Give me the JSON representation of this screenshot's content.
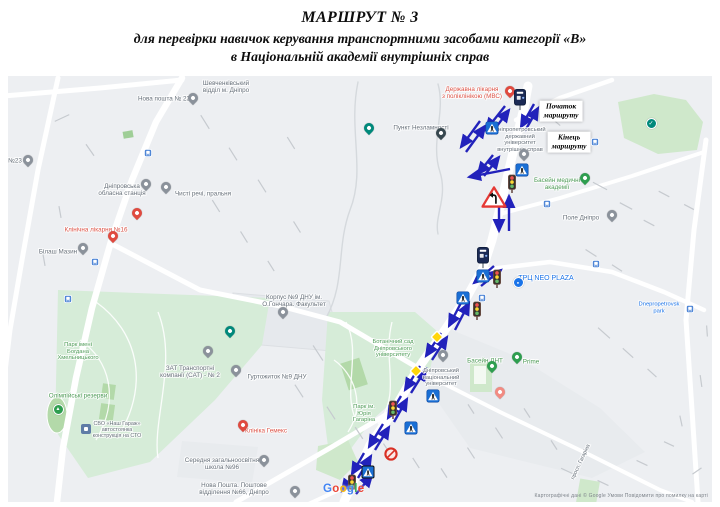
{
  "title": {
    "line1": "МАРШРУТ № 3",
    "line2": "для перевірки навичок керування транспортними засобами категорії «В»",
    "line3": "в Національній академії внутрішніх справ"
  },
  "colors": {
    "arrow": "#2222bb",
    "gray": "#67707a",
    "red": "#dd5347",
    "green": "#4e9b57",
    "blue": "#1a73e8",
    "pin_red": "#e04a3f",
    "pin_salmon": "#f28b82",
    "pin_gray": "#8b929b",
    "pin_navy": "#37474f",
    "pin_teal": "#00897b",
    "pin_green": "#2e9e4f",
    "pin_blue": "#1a73e8",
    "pin_slate": "#5f7ca6"
  },
  "map": {
    "route_labels": [
      {
        "text": "Початок\nмаршруту",
        "x": 561,
        "y": 111
      },
      {
        "text": "Кінець\nмаршруту",
        "x": 569,
        "y": 142
      }
    ],
    "labels": [
      {
        "text": "Нова пошта № 23",
        "x": 164,
        "y": 99,
        "color": "gray"
      },
      {
        "text": "Шевченківський\nвідділ м. Дніпро",
        "x": 226,
        "y": 87,
        "color": "gray"
      },
      {
        "text": "№23",
        "x": 15,
        "y": 161,
        "color": "gray"
      },
      {
        "text": "Дніпровська\nобласна станція",
        "x": 122,
        "y": 190,
        "color": "gray"
      },
      {
        "text": "Чисті речі, пральня",
        "x": 203,
        "y": 194,
        "color": "gray"
      },
      {
        "text": "Клінічна лікарня №16",
        "x": 96,
        "y": 230,
        "color": "red"
      },
      {
        "text": "Білаш Мазин",
        "x": 58,
        "y": 252,
        "color": "gray"
      },
      {
        "text": "Пункт Незламності",
        "x": 421,
        "y": 128,
        "color": "gray"
      },
      {
        "text": "Державна лікарня\nз поліклінікою (МВС)",
        "x": 472,
        "y": 93,
        "color": "red"
      },
      {
        "text": "Дніпропетровський\nдержавний\nуніверситет\nвнутрішніх справ",
        "x": 520,
        "y": 140,
        "color": "gray",
        "size": 5.8
      },
      {
        "text": "Басейн медичні\nакадемії",
        "x": 557,
        "y": 184,
        "color": "green"
      },
      {
        "text": "Поле Дніпро",
        "x": 581,
        "y": 218,
        "color": "gray"
      },
      {
        "text": "ТРЦ NEO PLAZA",
        "x": 546,
        "y": 279,
        "color": "blue",
        "size": 7
      },
      {
        "text": "Dnepropetrovsk park",
        "x": 659,
        "y": 308,
        "color": "blue",
        "size": 5.8
      },
      {
        "text": "Корпус №9 ДНУ ім.\nО.Гончара. Факультет",
        "x": 294,
        "y": 301,
        "color": "gray"
      },
      {
        "text": "Гуртожиток №9 ДНУ",
        "x": 277,
        "y": 377,
        "color": "gray"
      },
      {
        "text": "Ботанічний сад\nДніпровського\nуніверситету",
        "x": 393,
        "y": 349,
        "color": "green",
        "size": 5.8
      },
      {
        "text": "Дніпровський\nнаціональний\nуніверситет",
        "x": 441,
        "y": 378,
        "color": "gray",
        "size": 5.8
      },
      {
        "text": "Басейн ДНТ",
        "x": 485,
        "y": 361,
        "color": "green"
      },
      {
        "text": "Prime",
        "x": 531,
        "y": 362,
        "color": "green"
      },
      {
        "text": "ЗАТ Транспортні\nкомпанії (САТ) - № 2",
        "x": 190,
        "y": 372,
        "color": "gray"
      },
      {
        "text": "Парк імені\nБогдана\nХмельницького",
        "x": 78,
        "y": 352,
        "color": "green",
        "size": 5.8
      },
      {
        "text": "Олімпійські резерви",
        "x": 78,
        "y": 396,
        "color": "green"
      },
      {
        "text": "СВО «Наш Гараж»\nавтостоянка\nконструкція на СТО",
        "x": 117,
        "y": 430,
        "color": "gray",
        "size": 5.4
      },
      {
        "text": "Парк ім.\nЮрія\nГагаріна",
        "x": 364,
        "y": 414,
        "color": "green",
        "size": 5.8
      },
      {
        "text": "Клініка Гемекс",
        "x": 266,
        "y": 431,
        "color": "red"
      },
      {
        "text": "Середня загальноосвітня\nшкола №96",
        "x": 222,
        "y": 464,
        "color": "gray"
      },
      {
        "text": "Нова Пошта. Поштове\nвідділення №66, Дніпро",
        "x": 234,
        "y": 489,
        "color": "gray"
      },
      {
        "text": "просп. Гагаріна",
        "x": 581,
        "y": 462,
        "color": "gray",
        "size": 5.4,
        "rot": -65
      }
    ],
    "pins": [
      {
        "x": 510,
        "y": 97,
        "kind": "red"
      },
      {
        "x": 137,
        "y": 219,
        "kind": "red"
      },
      {
        "x": 113,
        "y": 242,
        "kind": "red"
      },
      {
        "x": 243,
        "y": 431,
        "kind": "red"
      },
      {
        "x": 500,
        "y": 398,
        "kind": "salmon"
      },
      {
        "x": 193,
        "y": 104,
        "kind": "gray"
      },
      {
        "x": 28,
        "y": 166,
        "kind": "gray"
      },
      {
        "x": 146,
        "y": 190,
        "kind": "gray"
      },
      {
        "x": 166,
        "y": 193,
        "kind": "gray"
      },
      {
        "x": 83,
        "y": 254,
        "kind": "gray"
      },
      {
        "x": 283,
        "y": 318,
        "kind": "gray"
      },
      {
        "x": 236,
        "y": 376,
        "kind": "gray"
      },
      {
        "x": 208,
        "y": 357,
        "kind": "gray"
      },
      {
        "x": 443,
        "y": 361,
        "kind": "gray"
      },
      {
        "x": 524,
        "y": 160,
        "kind": "gray"
      },
      {
        "x": 264,
        "y": 466,
        "kind": "gray"
      },
      {
        "x": 295,
        "y": 497,
        "kind": "gray"
      },
      {
        "x": 612,
        "y": 221,
        "kind": "gray"
      },
      {
        "x": 441,
        "y": 139,
        "kind": "navy"
      },
      {
        "x": 369,
        "y": 134,
        "kind": "teal"
      },
      {
        "x": 230,
        "y": 337,
        "kind": "teal"
      },
      {
        "x": 585,
        "y": 184,
        "kind": "green"
      },
      {
        "x": 492,
        "y": 372,
        "kind": "green"
      },
      {
        "x": 517,
        "y": 363,
        "kind": "green"
      },
      {
        "x": 57,
        "y": 408,
        "kind": "green-circle"
      },
      {
        "x": 650,
        "y": 122,
        "kind": "teal-check"
      },
      {
        "x": 517,
        "y": 281,
        "kind": "blue-circle"
      },
      {
        "x": 86,
        "y": 429,
        "kind": "blue-square"
      }
    ],
    "signs": [
      {
        "x": 520,
        "y": 100,
        "type": "parking-meter"
      },
      {
        "x": 483,
        "y": 258,
        "type": "parking-meter"
      },
      {
        "x": 492,
        "y": 128,
        "type": "crosswalk"
      },
      {
        "x": 522,
        "y": 170,
        "type": "crosswalk"
      },
      {
        "x": 483,
        "y": 276,
        "type": "crosswalk"
      },
      {
        "x": 463,
        "y": 298,
        "type": "crosswalk"
      },
      {
        "x": 433,
        "y": 396,
        "type": "crosswalk"
      },
      {
        "x": 411,
        "y": 428,
        "type": "crosswalk"
      },
      {
        "x": 368,
        "y": 472,
        "type": "crosswalk-dark"
      },
      {
        "x": 512,
        "y": 184,
        "type": "traffic-light"
      },
      {
        "x": 497,
        "y": 279,
        "type": "traffic-light"
      },
      {
        "x": 477,
        "y": 311,
        "type": "traffic-light"
      },
      {
        "x": 393,
        "y": 410,
        "type": "traffic-light"
      },
      {
        "x": 352,
        "y": 484,
        "type": "traffic-light"
      },
      {
        "x": 494,
        "y": 197,
        "type": "warning-turn"
      },
      {
        "x": 437,
        "y": 337,
        "type": "priority-diamond"
      },
      {
        "x": 416,
        "y": 371,
        "type": "priority-diamond"
      },
      {
        "x": 391,
        "y": 454,
        "type": "no-stopping"
      }
    ],
    "transit_icons": [
      {
        "x": 148,
        "y": 153
      },
      {
        "x": 95,
        "y": 262
      },
      {
        "x": 68,
        "y": 299
      },
      {
        "x": 547,
        "y": 204
      },
      {
        "x": 595,
        "y": 142
      },
      {
        "x": 596,
        "y": 264
      },
      {
        "x": 482,
        "y": 298
      },
      {
        "x": 690,
        "y": 309
      }
    ],
    "arrows": [
      {
        "x1": 480,
        "y1": 121,
        "x2": 461,
        "y2": 147
      },
      {
        "x1": 466,
        "y1": 152,
        "x2": 485,
        "y2": 126
      },
      {
        "x1": 505,
        "y1": 106,
        "x2": 486,
        "y2": 130
      },
      {
        "x1": 491,
        "y1": 134,
        "x2": 509,
        "y2": 110
      },
      {
        "x1": 534,
        "y1": 104,
        "x2": 521,
        "y2": 127
      },
      {
        "x1": 525,
        "y1": 131,
        "x2": 538,
        "y2": 108
      },
      {
        "x1": 510,
        "y1": 169,
        "x2": 469,
        "y2": 177
      },
      {
        "x1": 493,
        "y1": 155,
        "x2": 478,
        "y2": 174
      },
      {
        "x1": 484,
        "y1": 176,
        "x2": 499,
        "y2": 157
      },
      {
        "x1": 499,
        "y1": 196,
        "x2": 499,
        "y2": 231
      },
      {
        "x1": 509,
        "y1": 231,
        "x2": 509,
        "y2": 196
      },
      {
        "x1": 494,
        "y1": 266,
        "x2": 474,
        "y2": 283
      },
      {
        "x1": 481,
        "y1": 286,
        "x2": 501,
        "y2": 270
      },
      {
        "x1": 463,
        "y1": 299,
        "x2": 449,
        "y2": 326
      },
      {
        "x1": 455,
        "y1": 330,
        "x2": 469,
        "y2": 303
      },
      {
        "x1": 441,
        "y1": 333,
        "x2": 426,
        "y2": 356
      },
      {
        "x1": 432,
        "y1": 360,
        "x2": 447,
        "y2": 337
      },
      {
        "x1": 420,
        "y1": 366,
        "x2": 405,
        "y2": 390
      },
      {
        "x1": 411,
        "y1": 393,
        "x2": 426,
        "y2": 369
      },
      {
        "x1": 401,
        "y1": 396,
        "x2": 388,
        "y2": 418
      },
      {
        "x1": 394,
        "y1": 422,
        "x2": 407,
        "y2": 399
      },
      {
        "x1": 383,
        "y1": 424,
        "x2": 369,
        "y2": 447
      },
      {
        "x1": 375,
        "y1": 450,
        "x2": 389,
        "y2": 427
      },
      {
        "x1": 364,
        "y1": 453,
        "x2": 352,
        "y2": 474
      },
      {
        "x1": 358,
        "y1": 478,
        "x2": 371,
        "y2": 456
      },
      {
        "x1": 352,
        "y1": 477,
        "x2": 342,
        "y2": 491
      },
      {
        "x1": 356,
        "y1": 494,
        "x2": 372,
        "y2": 475
      }
    ],
    "google_logo": {
      "text": "Google",
      "letter_colors": [
        "#4285F4",
        "#EA4335",
        "#FBBC05",
        "#4285F4",
        "#34A853",
        "#EA4335"
      ],
      "x": 345,
      "y": 490
    },
    "attribution": "Картографічні дані © Google   Умови   Повідомити про помилку на карті"
  }
}
